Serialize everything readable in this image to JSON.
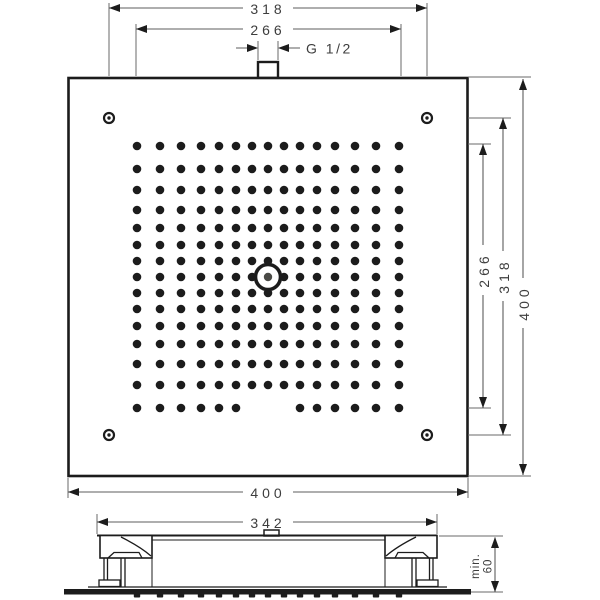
{
  "top_view": {
    "dim_top_mount": "318",
    "dim_top_nozzle_field": "266",
    "connector_label": "G 1/2",
    "dim_right_nozzle_field": "266",
    "dim_right_mount": "318",
    "dim_right_overall": "400",
    "dim_bottom_overall": "400",
    "nozzle_grid": {
      "rows": 15,
      "cols": 15,
      "offsets": [
        -131,
        -108,
        -87,
        -67,
        -49,
        -32,
        -16,
        0,
        16,
        32,
        49,
        67,
        87,
        108,
        131
      ],
      "missing": {
        "row_offset": 131,
        "col_offsets": [
          -16,
          0,
          16
        ]
      },
      "center": {
        "x": 268,
        "y": 277
      }
    }
  },
  "side_view": {
    "dim_width": "342",
    "dim_min_height_line1": "min.",
    "dim_min_height_line2": "60"
  },
  "colors": {
    "line": "#1c1c1c",
    "dim": "#5c5c5c",
    "text": "#3d3d3d",
    "background": "#ffffff"
  }
}
